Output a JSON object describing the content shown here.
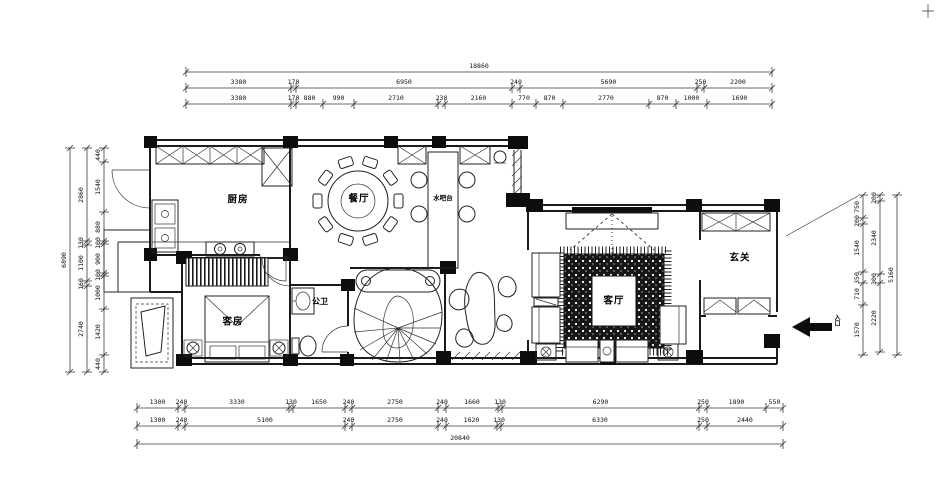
{
  "rooms": {
    "kitchen": "厨房",
    "dining": "餐厅",
    "water_bar": "水吧台",
    "living": "客厅",
    "foyer": "玄关",
    "guest": "客房",
    "bath": "公卫",
    "entrance": "入口"
  },
  "dims": {
    "top_total": [
      "18860"
    ],
    "top_row2": [
      "3380",
      "170",
      "6950",
      "240",
      "5690",
      "250",
      "2200"
    ],
    "top_row3": [
      "3380",
      "170",
      "880",
      "990",
      "2710",
      "230",
      "2160",
      "770",
      "870",
      "2770",
      "870",
      "1000",
      "1690"
    ],
    "bottom_row1": [
      "1300",
      "240",
      "3330",
      "130",
      "1650",
      "240",
      "2750",
      "240",
      "1660",
      "130",
      "6290",
      "250",
      "1890",
      "550"
    ],
    "bottom_row2": [
      "1300",
      "240",
      "5100",
      "240",
      "2750",
      "240",
      "1620",
      "130",
      "6330",
      "250",
      "2440"
    ],
    "bottom_total": [
      "20840"
    ],
    "left_inner": [
      "440",
      "1540",
      "880",
      "100",
      "900",
      "100",
      "1000",
      "1420",
      "440"
    ],
    "left_mid": [
      "2860",
      "130",
      "1100",
      "160",
      "2740"
    ],
    "left_total": [
      "6890"
    ],
    "right_inner": [
      "750",
      "200",
      "1540",
      "350",
      "710",
      "1570"
    ],
    "right_mid": [
      "200",
      "2340",
      "300",
      "2220"
    ],
    "right_total": [
      "5160"
    ]
  },
  "colors": {
    "line": "#1a1a1a",
    "fill_black": "#0d0d0d",
    "paper": "#ffffff"
  }
}
